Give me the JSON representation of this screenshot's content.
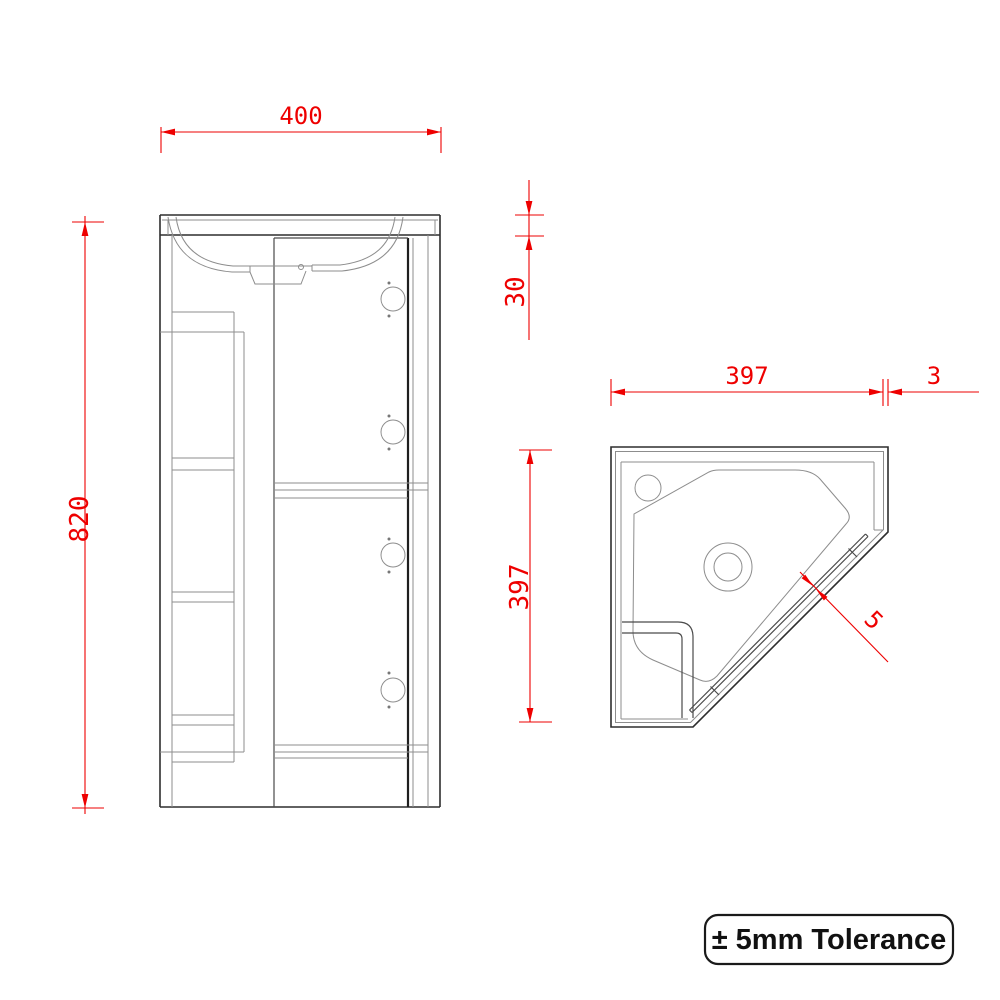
{
  "colors": {
    "background": "#ffffff",
    "dimension_red": "#ee0000",
    "drawing_dark": "#2e2e2e",
    "drawing_light": "#8d8d8d",
    "note_border": "#1a1a1a",
    "note_text": "#111111"
  },
  "front_view": {
    "width_dim": "400",
    "height_dim": "820",
    "worktop_thickness_dim": "30"
  },
  "plan_view": {
    "width_dim": "397",
    "depth_dim": "397",
    "worktop_overhang_dim": "3",
    "door_gap_dim": "5"
  },
  "tolerance_note": "± 5mm Tolerance"
}
